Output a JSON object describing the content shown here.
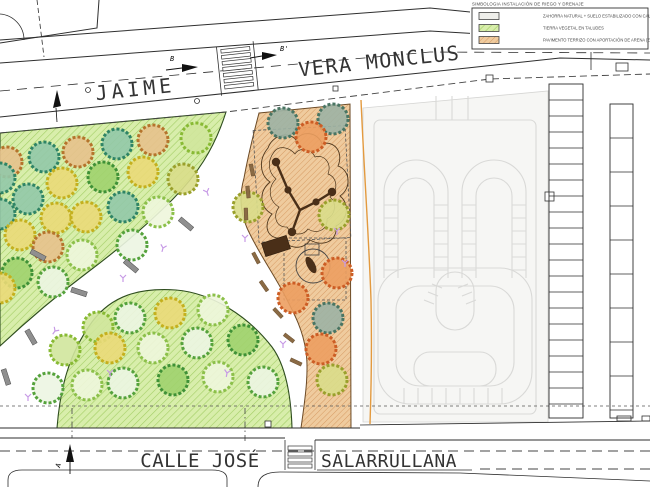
{
  "legend": {
    "title": "SIMBOLOGIA INSTALACIÓN DE RIEGO Y DRENAJE",
    "items": [
      {
        "label": "ZAHORRA NATURAL + SUELO ESTABILIZADO CON CAL",
        "swatch": "plain"
      },
      {
        "label": "TIERRA VEGETAL EN TALUDES",
        "swatch": "green-hatch"
      },
      {
        "label": "PAVIMENTO TERRIZO CON APORTACIÓN DE ARENA (ZONA DE JUEGO)",
        "swatch": "orange-hatch"
      }
    ]
  },
  "streets": {
    "top_left": "JAIME",
    "top_right": "VERA  MONCLUS",
    "bottom_left": "CALLE JOSÉ",
    "bottom_right": "SALARRULLANA"
  },
  "section_markers": {
    "a": "A",
    "b": "B",
    "b_prime": "B'"
  },
  "colors": {
    "green_fill": "#d8eeab",
    "green_hatch": "#a3ce65",
    "orange_fill": "#efcb9e",
    "orange_hatch": "#d3945c",
    "track_fill": "#f6f6f4",
    "track_line": "#d9d9d7",
    "irrigation_line": "#e39a3f",
    "sprinkler": "#c79ae6",
    "bench_gray": "#8f8f8f",
    "edge_brown": "#8a6a44",
    "play_dark": "#4a2f18"
  },
  "tree_palette": {
    "o": {
      "s": "#b5742c",
      "f": "#e7c18c"
    },
    "r": {
      "s": "#cc5d25",
      "f": "#ec9f60"
    },
    "t": {
      "s": "#2f8465",
      "f": "#92c8a8"
    },
    "g": {
      "s": "#3f9137",
      "f": "#a0d16e"
    },
    "y": {
      "s": "#c4b01e",
      "f": "#ead978"
    },
    "l": {
      "s": "#88ba34",
      "f": "#d0e69c"
    },
    "lo": {
      "s": "#8cc04a",
      "f": "#eef6dc"
    },
    "go": {
      "s": "#55a23c",
      "f": "#ecf5e2"
    },
    "v": {
      "s": "#9aa02c",
      "f": "#d9dd8a"
    },
    "td": {
      "s": "#4a7563",
      "f": "#9cb3a4"
    }
  },
  "trees": [
    [
      7,
      162,
      "o"
    ],
    [
      44,
      157,
      "t"
    ],
    [
      78,
      152,
      "o"
    ],
    [
      117,
      144,
      "t"
    ],
    [
      153,
      140,
      "o"
    ],
    [
      196,
      138,
      "l"
    ],
    [
      0,
      178,
      "t"
    ],
    [
      62,
      183,
      "y"
    ],
    [
      103,
      177,
      "g"
    ],
    [
      143,
      172,
      "y"
    ],
    [
      183,
      179,
      "v"
    ],
    [
      28,
      199,
      "t"
    ],
    [
      0,
      214,
      "t"
    ],
    [
      56,
      218,
      "y"
    ],
    [
      86,
      217,
      "y"
    ],
    [
      123,
      207,
      "t"
    ],
    [
      158,
      212,
      "lo"
    ],
    [
      20,
      235,
      "y"
    ],
    [
      48,
      247,
      "o"
    ],
    [
      82,
      255,
      "lo"
    ],
    [
      132,
      245,
      "go"
    ],
    [
      17,
      273,
      "g"
    ],
    [
      53,
      282,
      "go"
    ],
    [
      0,
      288,
      "y"
    ],
    [
      65,
      350,
      "l"
    ],
    [
      98,
      327,
      "l"
    ],
    [
      130,
      318,
      "go"
    ],
    [
      110,
      348,
      "y"
    ],
    [
      153,
      348,
      "lo"
    ],
    [
      197,
      343,
      "go"
    ],
    [
      170,
      313,
      "y"
    ],
    [
      213,
      310,
      "lo"
    ],
    [
      243,
      340,
      "g"
    ],
    [
      48,
      388,
      "go"
    ],
    [
      87,
      385,
      "lo"
    ],
    [
      123,
      383,
      "go"
    ],
    [
      173,
      380,
      "g"
    ],
    [
      218,
      377,
      "lo"
    ],
    [
      263,
      382,
      "go"
    ],
    [
      283,
      123,
      "td"
    ],
    [
      333,
      119,
      "td"
    ],
    [
      311,
      137,
      "r"
    ],
    [
      248,
      207,
      "v"
    ],
    [
      334,
      215,
      "v"
    ],
    [
      337,
      273,
      "r"
    ],
    [
      293,
      298,
      "r"
    ],
    [
      328,
      318,
      "td"
    ],
    [
      321,
      349,
      "r"
    ],
    [
      332,
      380,
      "v"
    ]
  ],
  "benches": [
    [
      186,
      224,
      40
    ],
    [
      131,
      266,
      40
    ],
    [
      79,
      292,
      18
    ],
    [
      31,
      337,
      60
    ],
    [
      6,
      377,
      72
    ],
    [
      38,
      255,
      28
    ]
  ],
  "edge_segments": [
    [
      252,
      170,
      78
    ],
    [
      248,
      192,
      84
    ],
    [
      246,
      214,
      88
    ],
    [
      256,
      258,
      62
    ],
    [
      264,
      286,
      55
    ],
    [
      278,
      313,
      47
    ],
    [
      289,
      338,
      38
    ],
    [
      296,
      362,
      25
    ]
  ],
  "sprinklers": [
    [
      207,
      192,
      -20
    ],
    [
      163,
      248,
      15
    ],
    [
      123,
      278,
      0
    ],
    [
      55,
      331,
      35
    ],
    [
      28,
      397,
      0
    ],
    [
      110,
      373,
      0
    ],
    [
      227,
      373,
      10
    ],
    [
      283,
      344,
      0
    ],
    [
      337,
      231,
      0
    ],
    [
      345,
      263,
      0
    ],
    [
      245,
      238,
      0
    ]
  ],
  "parking_strips": [
    {
      "x": 549,
      "w": 34,
      "y1": 84,
      "y2": 418,
      "step": 16
    },
    {
      "x": 610,
      "w": 23,
      "y1": 104,
      "y2": 418,
      "step": 34
    }
  ]
}
